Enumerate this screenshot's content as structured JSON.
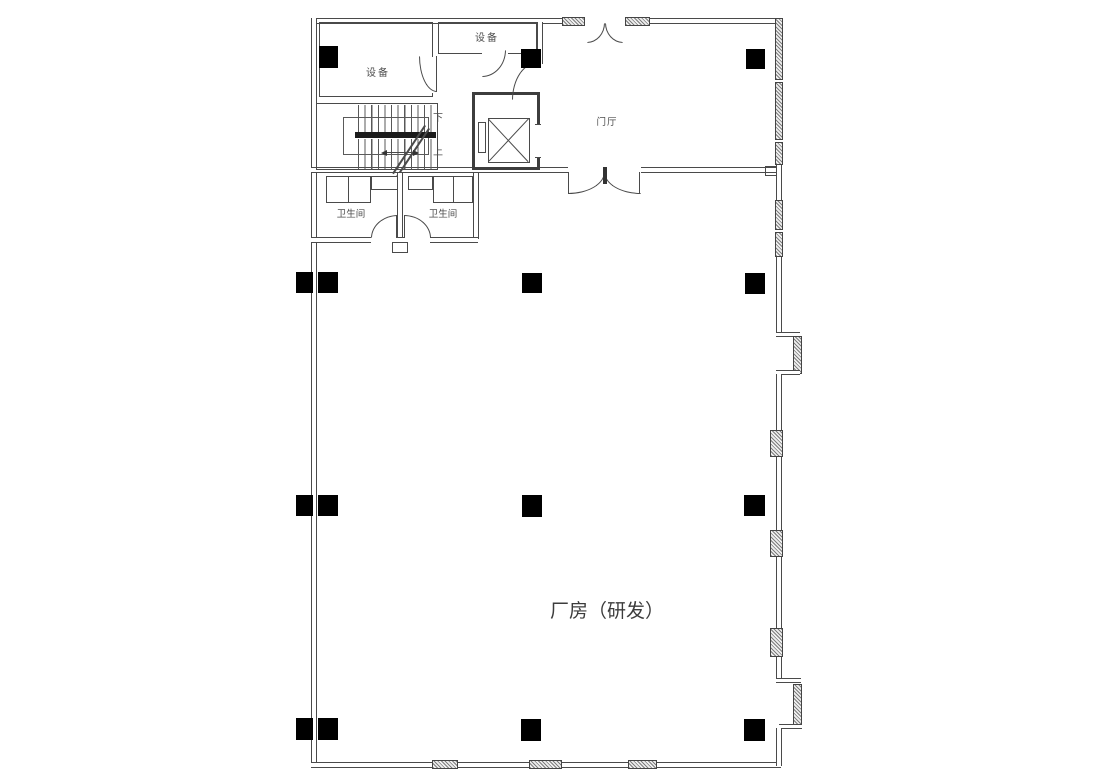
{
  "palette": {
    "background": "#ffffff",
    "line": "#4a4a4a",
    "column_fill": "#000000",
    "hatch_fill": "#7e7e7e",
    "label_color": "#4d4d4d"
  },
  "plan": {
    "rooms": [
      {
        "id": "equipment-main",
        "label": "设备"
      },
      {
        "id": "equipment-small",
        "label": "设备"
      },
      {
        "id": "foyer",
        "label": "门厅"
      },
      {
        "id": "toilet-left",
        "label": "卫生间"
      },
      {
        "id": "toilet-right",
        "label": "卫生间"
      },
      {
        "id": "workshop",
        "label": "厂房（研发）"
      }
    ],
    "stair": {
      "down": "下",
      "up": "上"
    }
  }
}
